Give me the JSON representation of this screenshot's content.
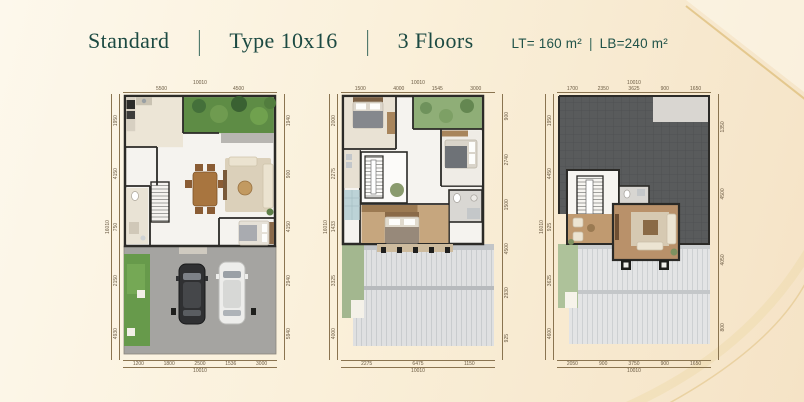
{
  "header": {
    "items": [
      "Standard",
      "Type 10x16",
      "3 Floors"
    ],
    "separator": "|",
    "lot_area": "LT= 160 m²",
    "area_separator": "|",
    "building_area": "LB=240 m²"
  },
  "colors": {
    "teal": "#1c4a42",
    "gold": "#ddbd7a",
    "cream1": "#fdf8ec",
    "cream2": "#f5e3c6",
    "wall": "#2b2a27",
    "paper": "#f5f3ef",
    "garden": "#5e8c45",
    "grass": "#679a4b",
    "driveway": "#a5a4a1",
    "roof_dark": "#595b5c",
    "roof_light": "#dfe0e1",
    "wood": "#b9916a",
    "dim": "#8a7450"
  },
  "plans": {
    "floor1": {
      "top_total": "10010",
      "top": [
        "5500",
        "4500"
      ],
      "left_total": "16010",
      "left": [
        "1950",
        "4150",
        "750",
        "2150",
        "4930"
      ],
      "right": [
        "1940",
        "900",
        "4150",
        "2940",
        "5940"
      ],
      "bottom": [
        "1200",
        "1800",
        "2500",
        "1536",
        "3000"
      ],
      "bottom_total": "10010"
    },
    "floor2": {
      "top_total": "10010",
      "top": [
        "1500",
        "4000",
        "1545",
        "3000"
      ],
      "left_total": "16010",
      "left": [
        "2000",
        "2275",
        "1433",
        "3325",
        "4000"
      ],
      "right": [
        "900",
        "2740",
        "1500",
        "4500",
        "2930",
        "925"
      ],
      "bottom": [
        "2275",
        "6475",
        "1150"
      ],
      "bottom_total": "10010"
    },
    "floor3": {
      "top_total": "10010",
      "top": [
        "1700",
        "2350",
        "3625",
        "900",
        "1650"
      ],
      "left_total": "16010",
      "left": [
        "1950",
        "4450",
        "925",
        "3625",
        "4600"
      ],
      "right": [
        "1350",
        "4500",
        "4050",
        "800"
      ],
      "bottom": [
        "2050",
        "900",
        "3750",
        "900",
        "1650"
      ],
      "bottom_total": "10010"
    }
  }
}
